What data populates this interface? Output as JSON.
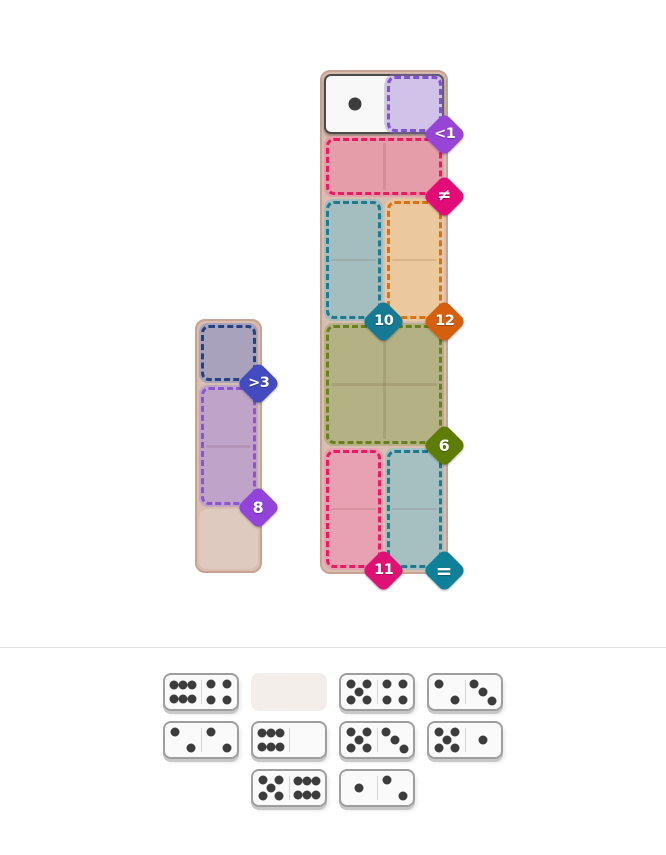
{
  "page": {
    "background": "#ffffff",
    "divider_color": "#e3e3e3"
  },
  "palette": {
    "board_bg": "#d9bdae",
    "board_border": "#c6a392",
    "empty_cell": "#decabe",
    "seam": "rgba(93,57,35,0.13)",
    "tile_bg": "#f9f8f8",
    "tile_border": "#4b4b4b",
    "pip_color": "#3c3c3c",
    "tray_domino_bg": "#fbfafa",
    "tray_domino_border": "#9e9e9e",
    "tray_domino_shadow": "#c9c6c6",
    "tray_divider": "#d9d5d3",
    "tray_slot_bg": "#f4eeea"
  },
  "board_small": {
    "cols": 1,
    "rows": 4,
    "regions": [
      {
        "name": "gt3",
        "col": 0,
        "row": 0,
        "w": 1,
        "h": 1,
        "fill": "#a9a2bd",
        "border": "#24427f",
        "badge": {
          "label": ">3",
          "color": "#434bc0"
        }
      },
      {
        "name": "sum8",
        "col": 0,
        "row": 1,
        "w": 1,
        "h": 2,
        "fill": "#bfa3c9",
        "border": "#8a56cf",
        "badge": {
          "label": "8",
          "color": "#9243d9"
        }
      }
    ],
    "empty_cells": [
      {
        "col": 0,
        "row": 3
      }
    ],
    "placed_dominoes": []
  },
  "board_large": {
    "cols": 2,
    "rows": 8,
    "regions": [
      {
        "name": "lt1",
        "col": 1,
        "row": 0,
        "w": 1,
        "h": 1,
        "fill": "rgba(147,113,211,0.40)",
        "border": "#7e51d5",
        "badge": {
          "label": "<1",
          "color": "#9645d5"
        }
      },
      {
        "name": "neq",
        "col": 0,
        "row": 1,
        "w": 2,
        "h": 1,
        "fill": "#e59da9",
        "border": "#eb195e",
        "badge": {
          "label": "≠",
          "color": "#e20b77"
        }
      },
      {
        "name": "sum10",
        "col": 0,
        "row": 2,
        "w": 1,
        "h": 2,
        "fill": "#a4bec0",
        "border": "#1f7a8e",
        "badge": {
          "label": "10",
          "color": "#157a93"
        }
      },
      {
        "name": "sum12",
        "col": 1,
        "row": 2,
        "w": 1,
        "h": 2,
        "fill": "#ecc89e",
        "border": "#df7012",
        "badge": {
          "label": "12",
          "color": "#d55f0d"
        }
      },
      {
        "name": "sum6",
        "col": 0,
        "row": 4,
        "w": 2,
        "h": 2,
        "fill": "#b4b184",
        "border": "#68801d",
        "badge": {
          "label": "6",
          "color": "#5d7d06"
        }
      },
      {
        "name": "sum11",
        "col": 0,
        "row": 6,
        "w": 1,
        "h": 2,
        "fill": "#e7a1b2",
        "border": "#eb1960",
        "badge": {
          "label": "11",
          "color": "#e01175"
        }
      },
      {
        "name": "eq",
        "col": 1,
        "row": 6,
        "w": 1,
        "h": 2,
        "fill": "#a6c0c2",
        "border": "#1f7a8e",
        "badge": {
          "label": "=",
          "color": "#0e8097"
        }
      }
    ],
    "empty_cells": [],
    "placed_dominoes": [
      {
        "col": 0,
        "row": 0,
        "w": 2,
        "h": 1,
        "pips": [
          1,
          0
        ]
      }
    ]
  },
  "tray": {
    "rows": [
      [
        {
          "type": "domino",
          "pips": [
            6,
            4
          ]
        },
        {
          "type": "slot"
        },
        {
          "type": "domino",
          "pips": [
            5,
            4
          ]
        },
        {
          "type": "domino",
          "pips": [
            2,
            3
          ]
        }
      ],
      [
        {
          "type": "domino",
          "pips": [
            2,
            2
          ]
        },
        {
          "type": "domino",
          "pips": [
            6,
            0
          ]
        },
        {
          "type": "domino",
          "pips": [
            5,
            3
          ]
        },
        {
          "type": "domino",
          "pips": [
            5,
            1
          ]
        }
      ],
      [
        {
          "type": "domino",
          "pips": [
            5,
            6
          ]
        },
        {
          "type": "domino",
          "pips": [
            1,
            2
          ]
        }
      ]
    ]
  }
}
